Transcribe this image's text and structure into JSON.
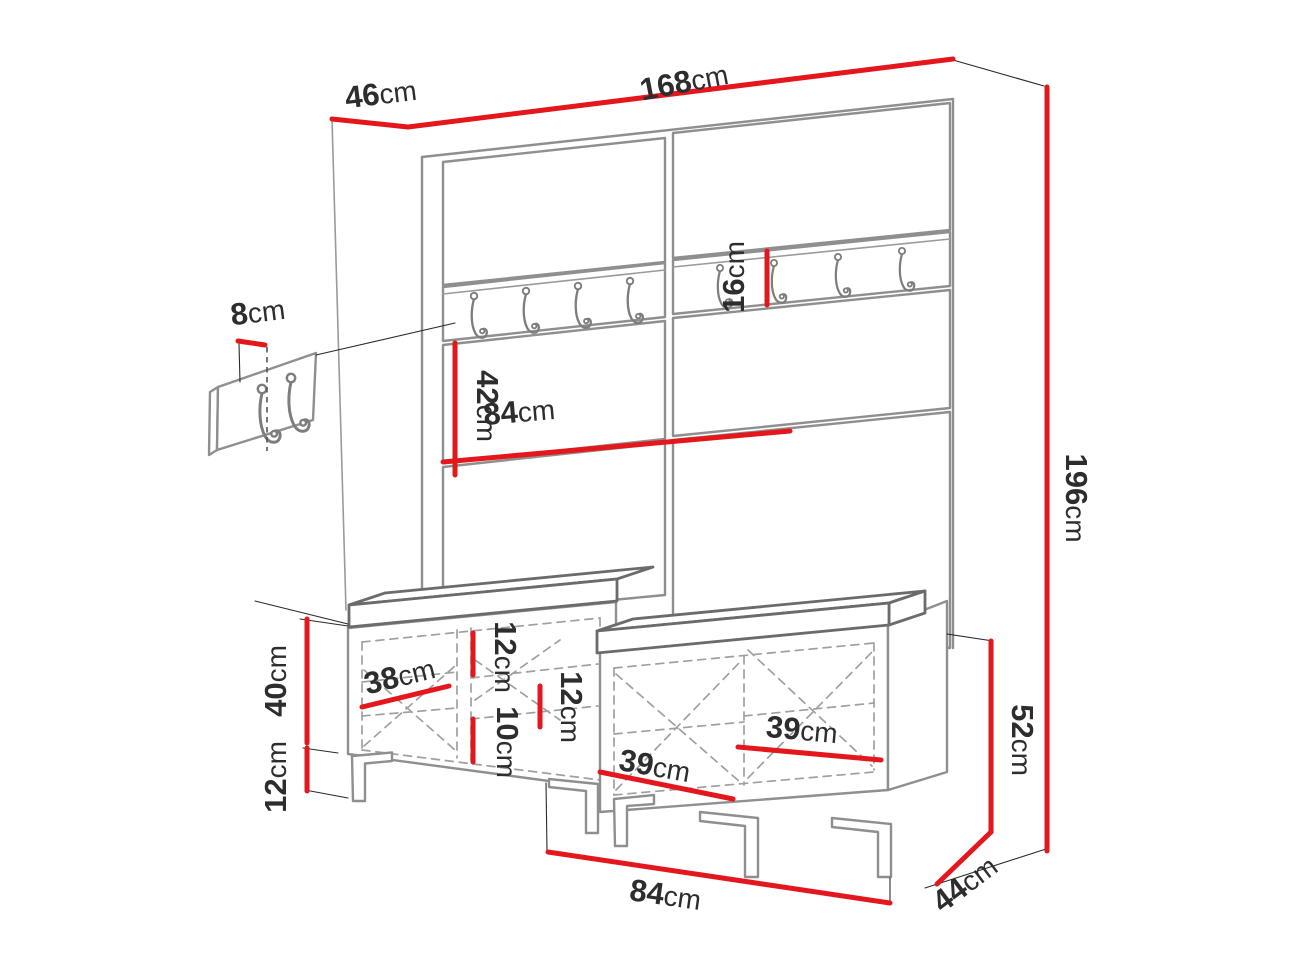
{
  "diagram": {
    "kind": "furniture-dimension-diagram",
    "subject": "hallway set: wall panel with coat hooks and shoe bench with cushions",
    "colors": {
      "dimension_red": "#e4171d",
      "outline_gray": "#8f8f8f",
      "text_dark": "#2d2d2f",
      "background": "#ffffff"
    }
  },
  "labels": {
    "top_width": {
      "value": "168",
      "unit": "cm"
    },
    "top_depth": {
      "value": "46",
      "unit": "cm"
    },
    "total_height": {
      "value": "196",
      "unit": "cm"
    },
    "detail_hook_offset": {
      "value": "8",
      "unit": "cm"
    },
    "hook_rail_height": {
      "value": "16",
      "unit": "cm"
    },
    "panel_section_height": {
      "value": "42",
      "unit": "cm"
    },
    "panel_width": {
      "value": "84",
      "unit": "cm"
    },
    "cabinet_body_height": {
      "value": "40",
      "unit": "cm"
    },
    "leg_height": {
      "value": "12",
      "unit": "cm"
    },
    "inner_depth_left": {
      "value": "38",
      "unit": "cm"
    },
    "shelf_gap_upper": {
      "value": "12",
      "unit": "cm"
    },
    "shelf_gap_lower": {
      "value": "10",
      "unit": "cm"
    },
    "shelf_gap_right": {
      "value": "12",
      "unit": "cm"
    },
    "compartment_width_a": {
      "value": "39",
      "unit": "cm"
    },
    "compartment_width_b": {
      "value": "39",
      "unit": "cm"
    },
    "bench_total_height": {
      "value": "52",
      "unit": "cm"
    },
    "bench_width": {
      "value": "84",
      "unit": "cm"
    },
    "bench_depth": {
      "value": "44",
      "unit": "cm"
    }
  }
}
